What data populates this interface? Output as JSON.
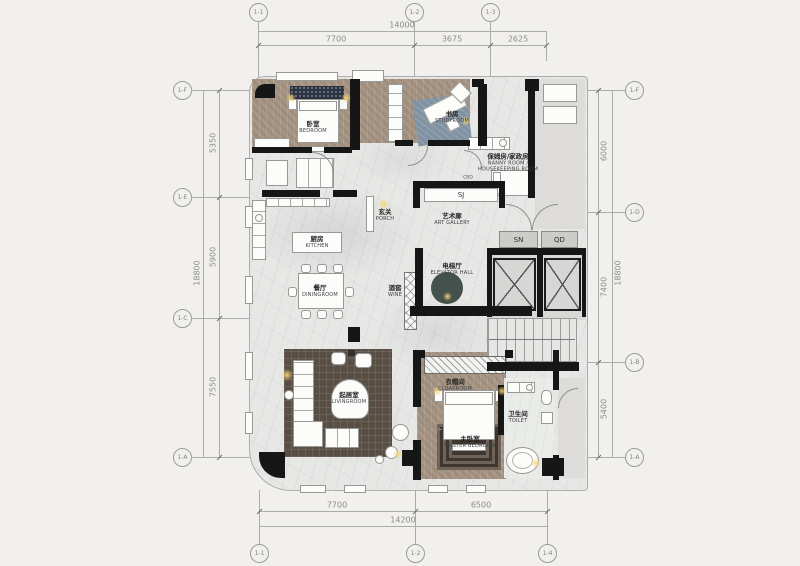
{
  "sheet": {
    "type": "apartment-floor-plan"
  },
  "grid": {
    "top": [
      "1-1",
      "1-2",
      "1-3"
    ],
    "bottom": [
      "1-1",
      "1-2",
      "1-4"
    ],
    "left": [
      "1-F",
      "1-E",
      "1-C",
      "1-A"
    ],
    "right": [
      "1-F",
      "1-D",
      "1-B",
      "1-A"
    ]
  },
  "dims": {
    "top": {
      "total": "14000",
      "segs": [
        "7700",
        "3675",
        "2625"
      ]
    },
    "bottom": {
      "total": "14200",
      "segs": [
        "7700",
        "6500"
      ]
    },
    "left": {
      "total": "18800",
      "segs": [
        "5350",
        "5900",
        "7550"
      ]
    },
    "right": {
      "total": "18800",
      "segs": [
        "6000",
        "7400",
        "5400"
      ]
    }
  },
  "rooms": {
    "bedroom": {
      "cn": "卧室",
      "en": "BEDROOM"
    },
    "study": {
      "cn": "书房",
      "en": "STUDYROOM"
    },
    "nanny": {
      "cn": "保姆房/家政房",
      "en": "NANNY ROOM / HOUSEKEEPING ROOM"
    },
    "porch": {
      "cn": "玄关",
      "en": "PORCH"
    },
    "gallery": {
      "cn": "艺术廊",
      "en": "ART GALLERY"
    },
    "kitchen": {
      "cn": "厨房",
      "en": "KITCHEN"
    },
    "dining": {
      "cn": "餐厅",
      "en": "DININGROOM"
    },
    "wine": {
      "cn": "酒窖",
      "en": "WINE"
    },
    "elevator": {
      "cn": "电梯厅",
      "en": "ELEVATOR HALL"
    },
    "living": {
      "cn": "起居室",
      "en": "LIVINGROOM"
    },
    "cloak": {
      "cn": "衣帽间",
      "en": "CLOAKROOM"
    },
    "master": {
      "cn": "主卧室",
      "en": "MASTER BEDROOM"
    },
    "toilet": {
      "cn": "卫生间",
      "en": "TOILET"
    }
  },
  "tags": {
    "sj": "SJ",
    "sn": "SN",
    "qd": "QD",
    "cbd": "CBD"
  },
  "colors": {
    "wall": "#161616",
    "wood": "#a89786",
    "marble": "#e7e8e6",
    "rug_living": "#594e44",
    "rug_study": "#8193a3",
    "headboard": "#2b3342",
    "glow": "#f7d67a",
    "core": "#d9d8d6"
  }
}
